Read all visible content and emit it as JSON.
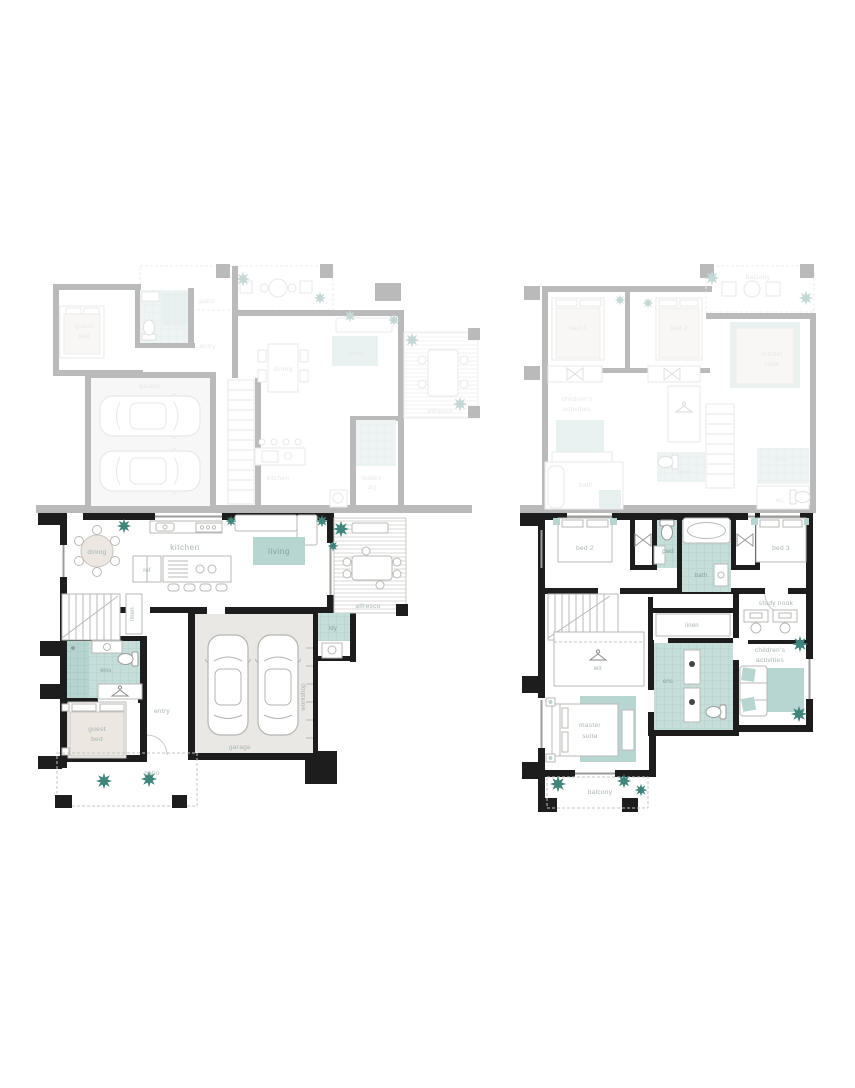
{
  "document": {
    "type": "floor-plan-sheet",
    "panels": [
      "ground-floor-plan",
      "first-floor-plan"
    ]
  },
  "plans": {
    "ground": {
      "labels": {
        "dining": "dining",
        "kitchen": "kitchen",
        "ref": "ref",
        "living": "living",
        "alfresco": "alfresco",
        "ldy": "ldy",
        "linen": "linen",
        "ens": "ens",
        "entry": "entry",
        "guest1": "guest",
        "guest2": "bed",
        "patio": "patio",
        "garage": "garage",
        "workshop": "workshop"
      },
      "ghost": {
        "guest1": "guest",
        "guest2": "bed",
        "patio": "patio",
        "entry": "entry",
        "garage": "garage",
        "dining": "dining",
        "living": "living",
        "kitchen": "kitchen",
        "butlers1": "butlers",
        "butlers2": "dry",
        "alfresco": "alfresco"
      }
    },
    "first": {
      "labels": {
        "bed2": "bed 2",
        "pwd": "pwd",
        "bath": "bath",
        "bed3": "bed 3",
        "study": "study nook",
        "linen": "linen",
        "child1": "children's",
        "child2": "activities",
        "wir": "wir",
        "ens": "ens",
        "master1": "master",
        "master2": "suite",
        "balcony": "balcony"
      },
      "ghost": {
        "bed3": "bed 3",
        "bed2": "bed 2",
        "balcony": "balcony",
        "master1": "master",
        "master2": "suite",
        "child1": "children's",
        "child2": "activities",
        "bath": "bath",
        "pwd": "pwd",
        "ens": "ens",
        "wc": "wc"
      }
    }
  },
  "colors": {
    "wall": "#1d1d1d",
    "wet_area_teal": "#c3dcd8",
    "shower_teal": "#b7d4d0",
    "rug_teal": "#b7d5d1",
    "plant_teal": "#3f857b",
    "floor_grey": "#eae8e5",
    "bed_beige": "#ece7e1",
    "label_grey": "#a8b4b2",
    "line_grey": "#b9b9b7"
  }
}
